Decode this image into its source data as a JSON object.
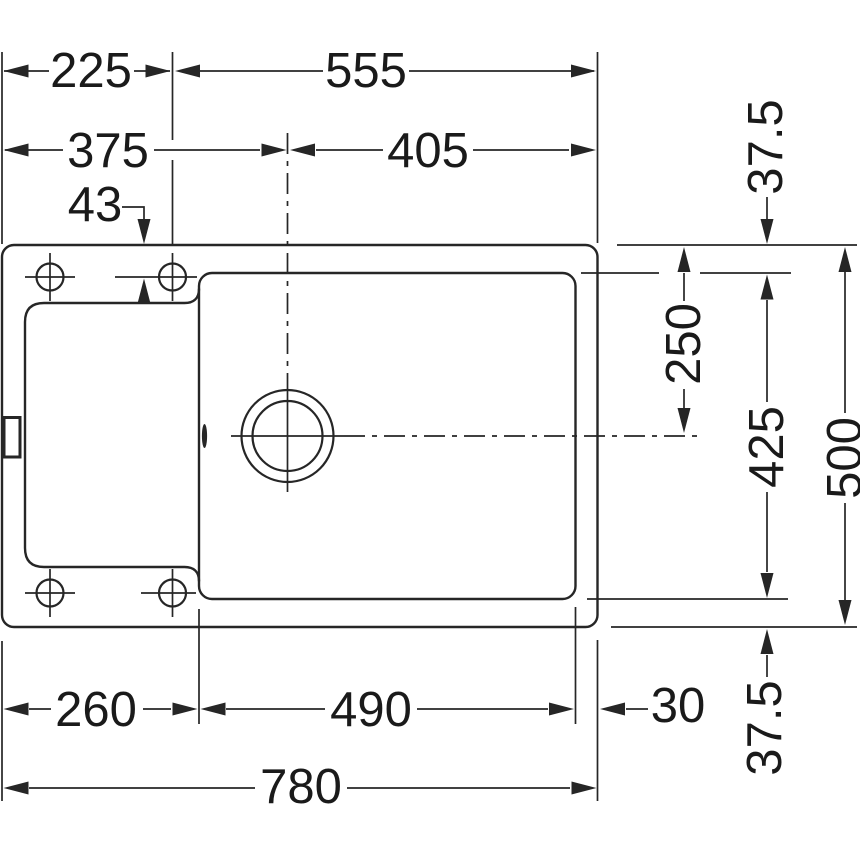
{
  "drawing": {
    "description": "Technical top-view installation drawing of a kitchen sink with left drainboard, main bowl and round drain, annotated with millimetre dimensions",
    "background_color": "#ffffff",
    "line_color": "#262626",
    "text_color": "#1a1a1a",
    "dims": {
      "left_to_hole": "225",
      "hole_to_right_edge": "555",
      "left_to_drain_center": "375",
      "drain_center_to_right_edge": "405",
      "top_edge_to_hole_center": "43",
      "top_rim_width": "37.5",
      "top_edge_to_drain_center": "250",
      "bowl_depth": "425",
      "overall_depth": "500",
      "bottom_rim_width": "37.5",
      "left_edge_to_bowl": "260",
      "bowl_width": "490",
      "bowl_to_right_edge": "30",
      "overall_width": "780"
    }
  }
}
